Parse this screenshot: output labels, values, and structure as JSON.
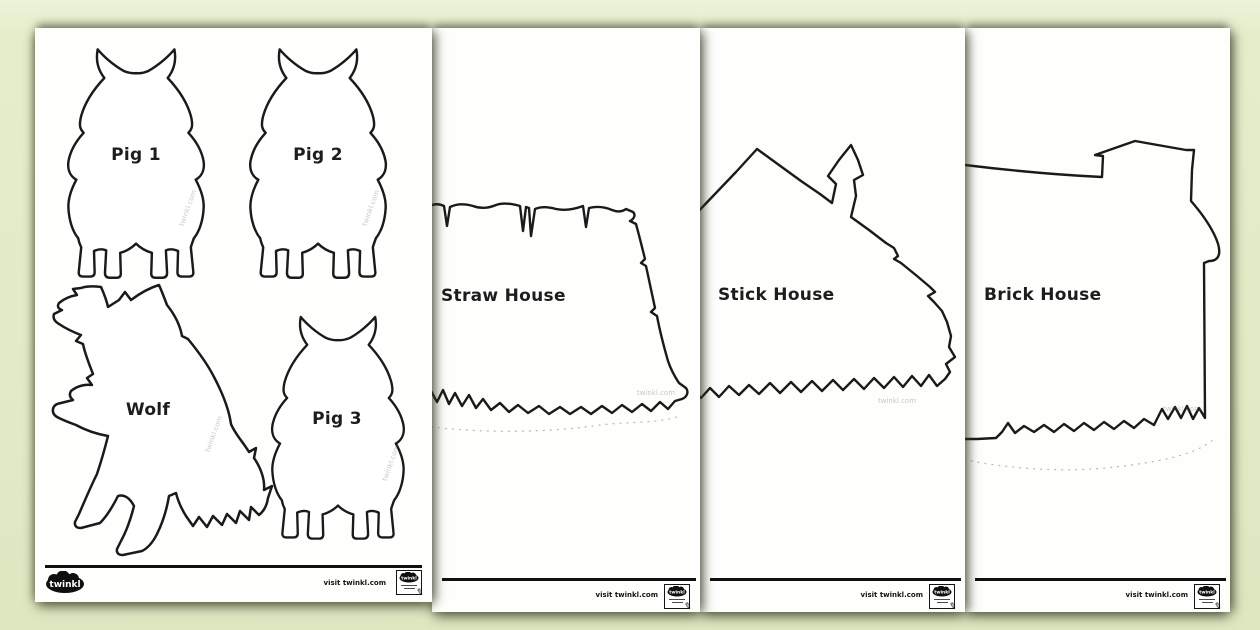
{
  "colors": {
    "background": "#e2ebc6",
    "page": "#fefefc",
    "outline": "#1a1a1a"
  },
  "watermark": "twinkl.com",
  "footer": {
    "visit": "visit twinkl.com",
    "brand": "twinkl"
  },
  "pages": {
    "characters": {
      "pig1": "Pig 1",
      "pig2": "Pig 2",
      "wolf": "Wolf",
      "pig3": "Pig 3"
    },
    "straw": {
      "label": "Straw House"
    },
    "stick": {
      "label": "Stick House"
    },
    "brick": {
      "label": "Brick House"
    }
  }
}
